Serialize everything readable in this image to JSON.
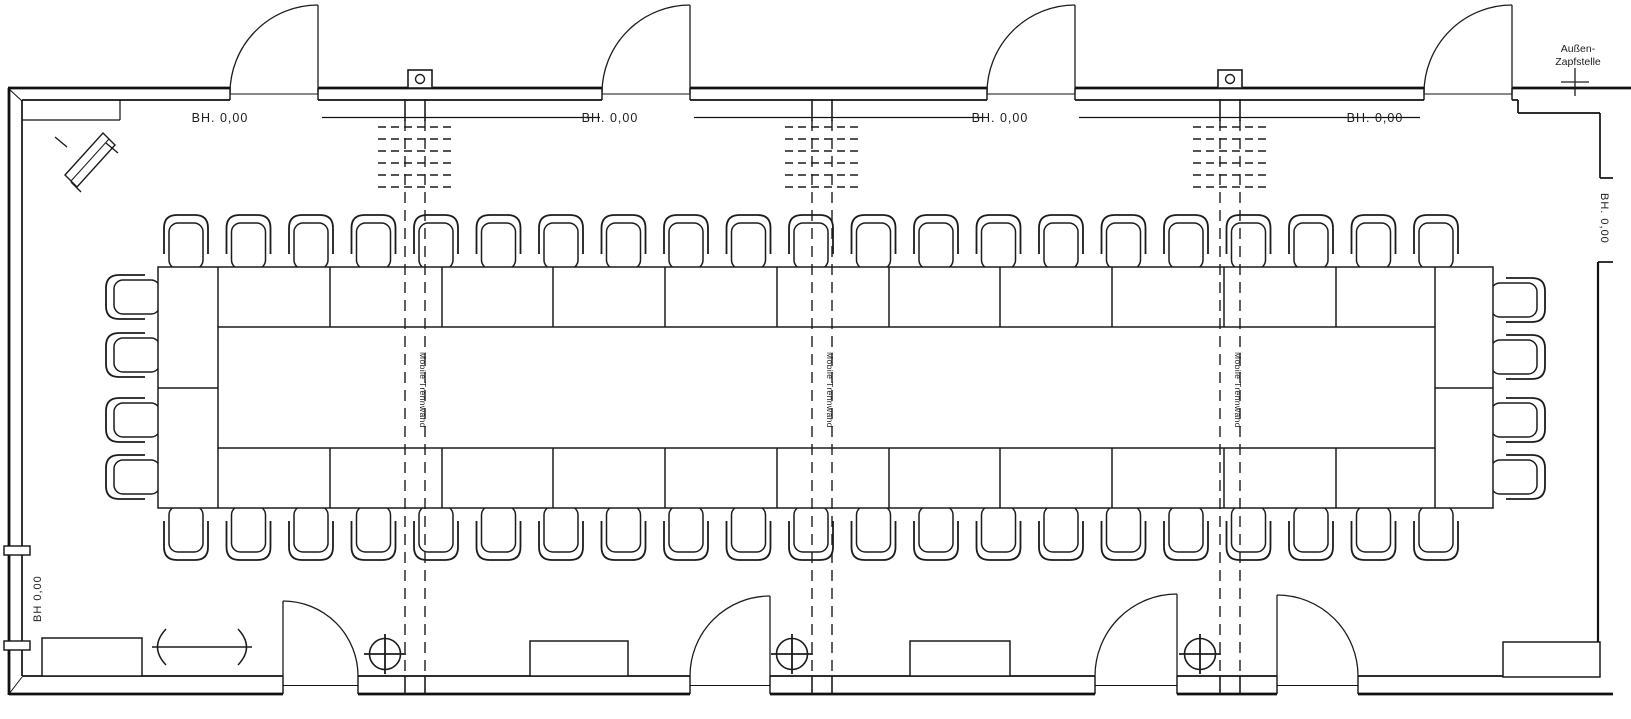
{
  "labels": {
    "bh_top": [
      "BH. 0,00",
      "BH. 0,00",
      "BH. 0,00",
      "BH. 0,00"
    ],
    "bh_left": "BH 0,00",
    "bh_right": "BH. 0,00",
    "aussen_line1": "Außen-",
    "aussen_line2": "Zapfstelle",
    "mobile_trennwand": [
      "Mobile Trennwand",
      "Mobile Trennwand",
      "Mobile Trennwand"
    ]
  },
  "colors": {
    "ink": "#1c1c1c",
    "paper": "#ffffff"
  }
}
